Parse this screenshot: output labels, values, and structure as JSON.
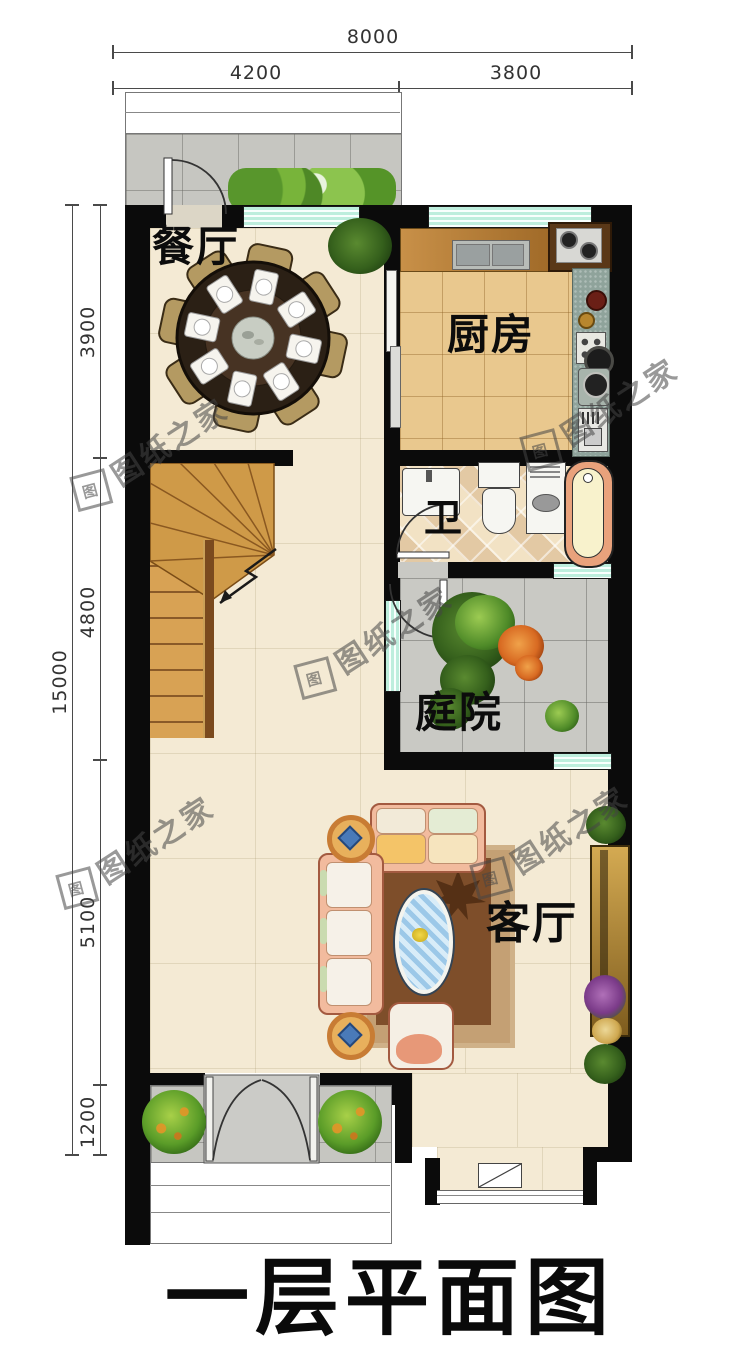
{
  "title": "一层平面图",
  "watermark": {
    "text": "图纸之家",
    "seal": "图"
  },
  "dimensions": {
    "top": {
      "total": "8000",
      "segments": [
        "4200",
        "3800"
      ]
    },
    "left": {
      "total": "15000",
      "segments": [
        "3900",
        "4800",
        "5100",
        "1200"
      ]
    }
  },
  "rooms": {
    "dining": "餐厅",
    "kitchen": "厨房",
    "bath": "卫",
    "courtyard": "庭院",
    "living": "客厅"
  },
  "colors": {
    "wall": "#0b0b0b",
    "window_glass": "#bdeedd",
    "floor_main": "#f4ead4",
    "floor_kitchen": "#e9c88e",
    "floor_courtyard": "#c9c9c4",
    "stair_wood": "#cf9a48",
    "sofa": "#f2bb9e",
    "tub": "#e9a27c"
  }
}
